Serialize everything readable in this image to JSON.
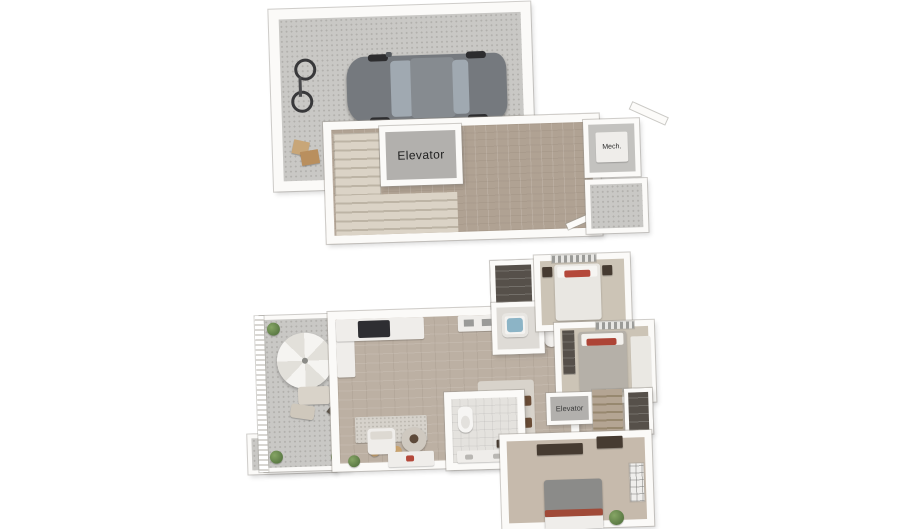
{
  "scene": {
    "kind": "3d-two-level-floor-plan",
    "background": "#ffffff"
  },
  "garage_level": {
    "elevator_label": "Elevator",
    "mech_label": "Mech."
  },
  "main_level": {
    "elevator_label": "Elevator"
  },
  "palette": {
    "wall": "#fbfaf8",
    "concrete_floor": "#c9c8c5",
    "wood_floor_upper": "#b0a293",
    "wood_floor_lower": "#bcb0a3",
    "carpet": "#ccc4b6",
    "stair_carpet": "#dbd3c6",
    "elevator_floor": "#b2b0ad",
    "car_body": "#75797e",
    "car_glass": "#a0a9b1",
    "accent_pillow_red": "#b4483a",
    "plant_green": "#6d8f5b",
    "tub_water": "#8cb4c6",
    "umbrella_white": "#f4f3f0"
  }
}
